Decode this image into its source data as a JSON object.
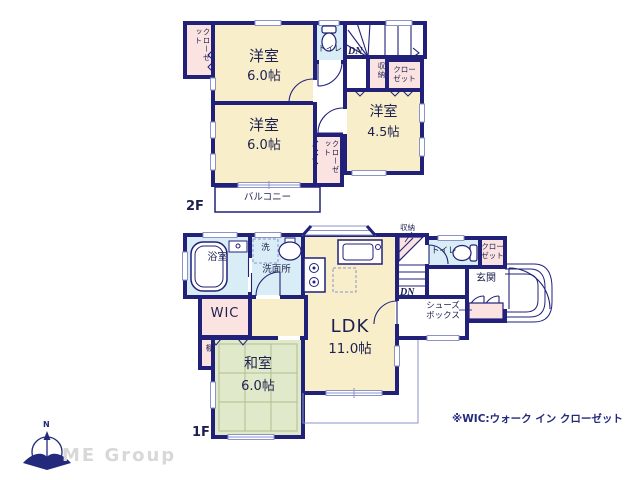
{
  "floor2": {
    "label": "2F",
    "room1_name": "洋室",
    "room1_size": "6.0帖",
    "room2_name": "洋室",
    "room2_size": "6.0帖",
    "room3_name": "洋室",
    "room3_size": "4.5帖",
    "closet_top_left": "クローゼット",
    "closet_middle": "クローゼット",
    "closet_right": "クローゼット",
    "storage": "収納",
    "toilet": "トイレ",
    "stairs_dn": "DN",
    "balcony": "バルコニー"
  },
  "floor1": {
    "label": "1F",
    "ldk_name": "LDK",
    "ldk_size": "11.0帖",
    "washitsu_name": "和室",
    "washitsu_size": "6.0帖",
    "bath": "浴室",
    "laundry": "洗",
    "washroom": "洗面所",
    "wic": "WIC",
    "shelf": "棚",
    "storage": "収納",
    "toilet": "トイレ",
    "closet": "クローゼット",
    "entrance": "玄関",
    "shoe_box": "シューズボックス",
    "stairs_dn": "DN"
  },
  "footer": {
    "note": "※WIC:ウォーク イン クローゼット",
    "brand": "ME Group",
    "compass_north": "N"
  },
  "colors": {
    "wall_navy": "#21217a",
    "room_cream": "#f9eeca",
    "closet_pink": "#fbe3e1",
    "wet_area_blue": "#d9edf6",
    "tatami_green": "#e0e9c9",
    "thin_line": "#8b93c8"
  }
}
